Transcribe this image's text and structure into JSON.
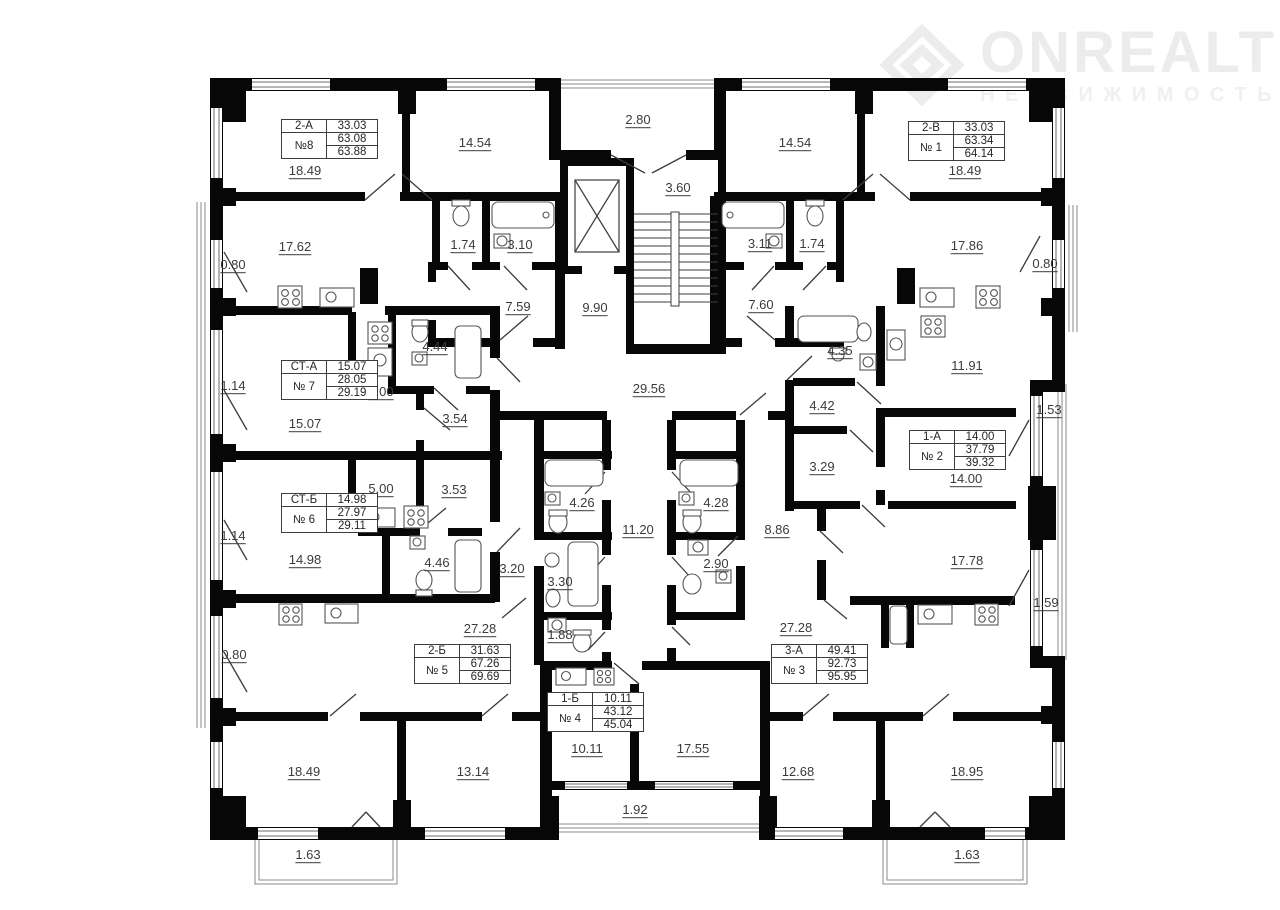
{
  "logo": {
    "brand": "ONREALT",
    "subtitle": "НЕДВИЖИМОСТЬ",
    "icon": "diamond-house-icon",
    "color": "#ececec"
  },
  "colors": {
    "wall": "#070707",
    "thin_line": "#6e6e6e",
    "label_text": "#3b3b3b",
    "table_border": "#3d3d3d"
  },
  "apartment_tables": [
    {
      "type": "2-А",
      "type_area": "33.03",
      "number": "№8",
      "living_area": "63.08",
      "total_area": "63.88",
      "x": 281,
      "y": 119
    },
    {
      "type": "2-В",
      "type_area": "33.03",
      "number": "№ 1",
      "living_area": "63.34",
      "total_area": "64.14",
      "x": 908,
      "y": 121
    },
    {
      "type": "СТ-А",
      "type_area": "15.07",
      "number": "№ 7",
      "living_area": "28.05",
      "total_area": "29.19",
      "x": 281,
      "y": 360
    },
    {
      "type": "1-А",
      "type_area": "14.00",
      "number": "№ 2",
      "living_area": "37.79",
      "total_area": "39.32",
      "x": 909,
      "y": 430
    },
    {
      "type": "СТ-Б",
      "type_area": "14.98",
      "number": "№ 6",
      "living_area": "27.97",
      "total_area": "29.11",
      "x": 281,
      "y": 493
    },
    {
      "type": "2-Б",
      "type_area": "31.63",
      "number": "№ 5",
      "living_area": "67.26",
      "total_area": "69.69",
      "x": 414,
      "y": 644
    },
    {
      "type": "3-А",
      "type_area": "49.41",
      "number": "№ 3",
      "living_area": "92.73",
      "total_area": "95.95",
      "x": 771,
      "y": 644
    },
    {
      "type": "1-Б",
      "type_area": "10.11",
      "number": "№ 4",
      "living_area": "43.12",
      "total_area": "45.04",
      "x": 547,
      "y": 692
    }
  ],
  "dimension_labels": [
    {
      "t": "2.80",
      "x": 638,
      "y": 120
    },
    {
      "t": "14.54",
      "x": 475,
      "y": 143
    },
    {
      "t": "14.54",
      "x": 795,
      "y": 143
    },
    {
      "t": "18.49",
      "x": 305,
      "y": 171
    },
    {
      "t": "18.49",
      "x": 965,
      "y": 171
    },
    {
      "t": "17.62",
      "x": 295,
      "y": 247
    },
    {
      "t": "0.80",
      "x": 233,
      "y": 265
    },
    {
      "t": "1.74",
      "x": 463,
      "y": 245
    },
    {
      "t": "3.10",
      "x": 520,
      "y": 245
    },
    {
      "t": "3.60",
      "x": 678,
      "y": 188
    },
    {
      "t": "3.11",
      "x": 760,
      "y": 244
    },
    {
      "t": "1.74",
      "x": 812,
      "y": 244
    },
    {
      "t": "17.86",
      "x": 967,
      "y": 246
    },
    {
      "t": "0.80",
      "x": 1045,
      "y": 264
    },
    {
      "t": "7.59",
      "x": 518,
      "y": 307
    },
    {
      "t": "9.90",
      "x": 595,
      "y": 308
    },
    {
      "t": "7.60",
      "x": 761,
      "y": 305
    },
    {
      "t": "29.56",
      "x": 649,
      "y": 389
    },
    {
      "t": "4.44",
      "x": 435,
      "y": 347
    },
    {
      "t": "5.00",
      "x": 381,
      "y": 392
    },
    {
      "t": "15.07",
      "x": 305,
      "y": 424
    },
    {
      "t": "3.54",
      "x": 455,
      "y": 419
    },
    {
      "t": "1.14",
      "x": 233,
      "y": 386
    },
    {
      "t": "4.35",
      "x": 840,
      "y": 351
    },
    {
      "t": "11.91",
      "x": 967,
      "y": 366
    },
    {
      "t": "4.42",
      "x": 822,
      "y": 406
    },
    {
      "t": "1.53",
      "x": 1049,
      "y": 410
    },
    {
      "t": "3.29",
      "x": 822,
      "y": 467
    },
    {
      "t": "14.00",
      "x": 966,
      "y": 479
    },
    {
      "t": "5.00",
      "x": 381,
      "y": 489
    },
    {
      "t": "3.53",
      "x": 454,
      "y": 490
    },
    {
      "t": "14.98",
      "x": 305,
      "y": 560
    },
    {
      "t": "4.46",
      "x": 437,
      "y": 563
    },
    {
      "t": "3.20",
      "x": 512,
      "y": 569
    },
    {
      "t": "1.14",
      "x": 233,
      "y": 536
    },
    {
      "t": "4.26",
      "x": 582,
      "y": 503
    },
    {
      "t": "11.20",
      "x": 638,
      "y": 530
    },
    {
      "t": "4.28",
      "x": 716,
      "y": 503
    },
    {
      "t": "8.86",
      "x": 777,
      "y": 530
    },
    {
      "t": "3.30",
      "x": 560,
      "y": 582
    },
    {
      "t": "2.90",
      "x": 716,
      "y": 564
    },
    {
      "t": "1.88",
      "x": 560,
      "y": 635
    },
    {
      "t": "27.28",
      "x": 480,
      "y": 629
    },
    {
      "t": "27.28",
      "x": 796,
      "y": 628
    },
    {
      "t": "17.78",
      "x": 967,
      "y": 561
    },
    {
      "t": "1.59",
      "x": 1046,
      "y": 603
    },
    {
      "t": "0.80",
      "x": 234,
      "y": 655
    },
    {
      "t": "10.11",
      "x": 587,
      "y": 749
    },
    {
      "t": "17.55",
      "x": 693,
      "y": 749
    },
    {
      "t": "12.68",
      "x": 798,
      "y": 772
    },
    {
      "t": "18.95",
      "x": 967,
      "y": 772
    },
    {
      "t": "18.49",
      "x": 304,
      "y": 772
    },
    {
      "t": "13.14",
      "x": 473,
      "y": 772
    },
    {
      "t": "1.92",
      "x": 635,
      "y": 810
    },
    {
      "t": "1.63",
      "x": 308,
      "y": 855
    },
    {
      "t": "1.63",
      "x": 967,
      "y": 855
    }
  ]
}
